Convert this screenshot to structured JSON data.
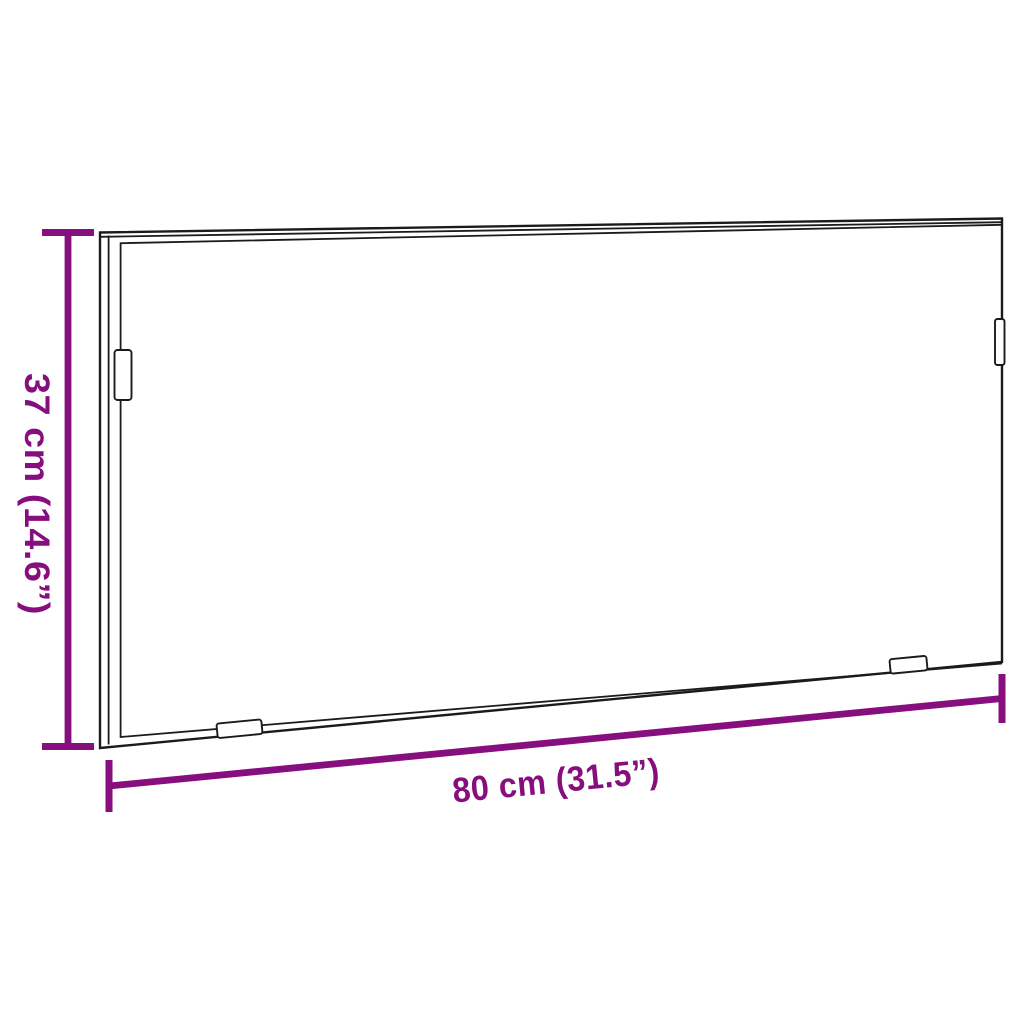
{
  "diagram": {
    "kind": "product-dimension-diagram",
    "subject": "rectangular-frame-mirror-outline",
    "height_label": "37 cm (14.6”)",
    "width_label": "80 cm (31.5”)",
    "dimensions": {
      "height_cm": 37,
      "height_inch": 14.6,
      "width_cm": 80,
      "width_inch": 31.5
    },
    "mounting_bracket_count": 4,
    "colors": {
      "dimension_accent": "#870e7e",
      "outline": "#1b1b1b",
      "background": "#ffffff"
    }
  }
}
